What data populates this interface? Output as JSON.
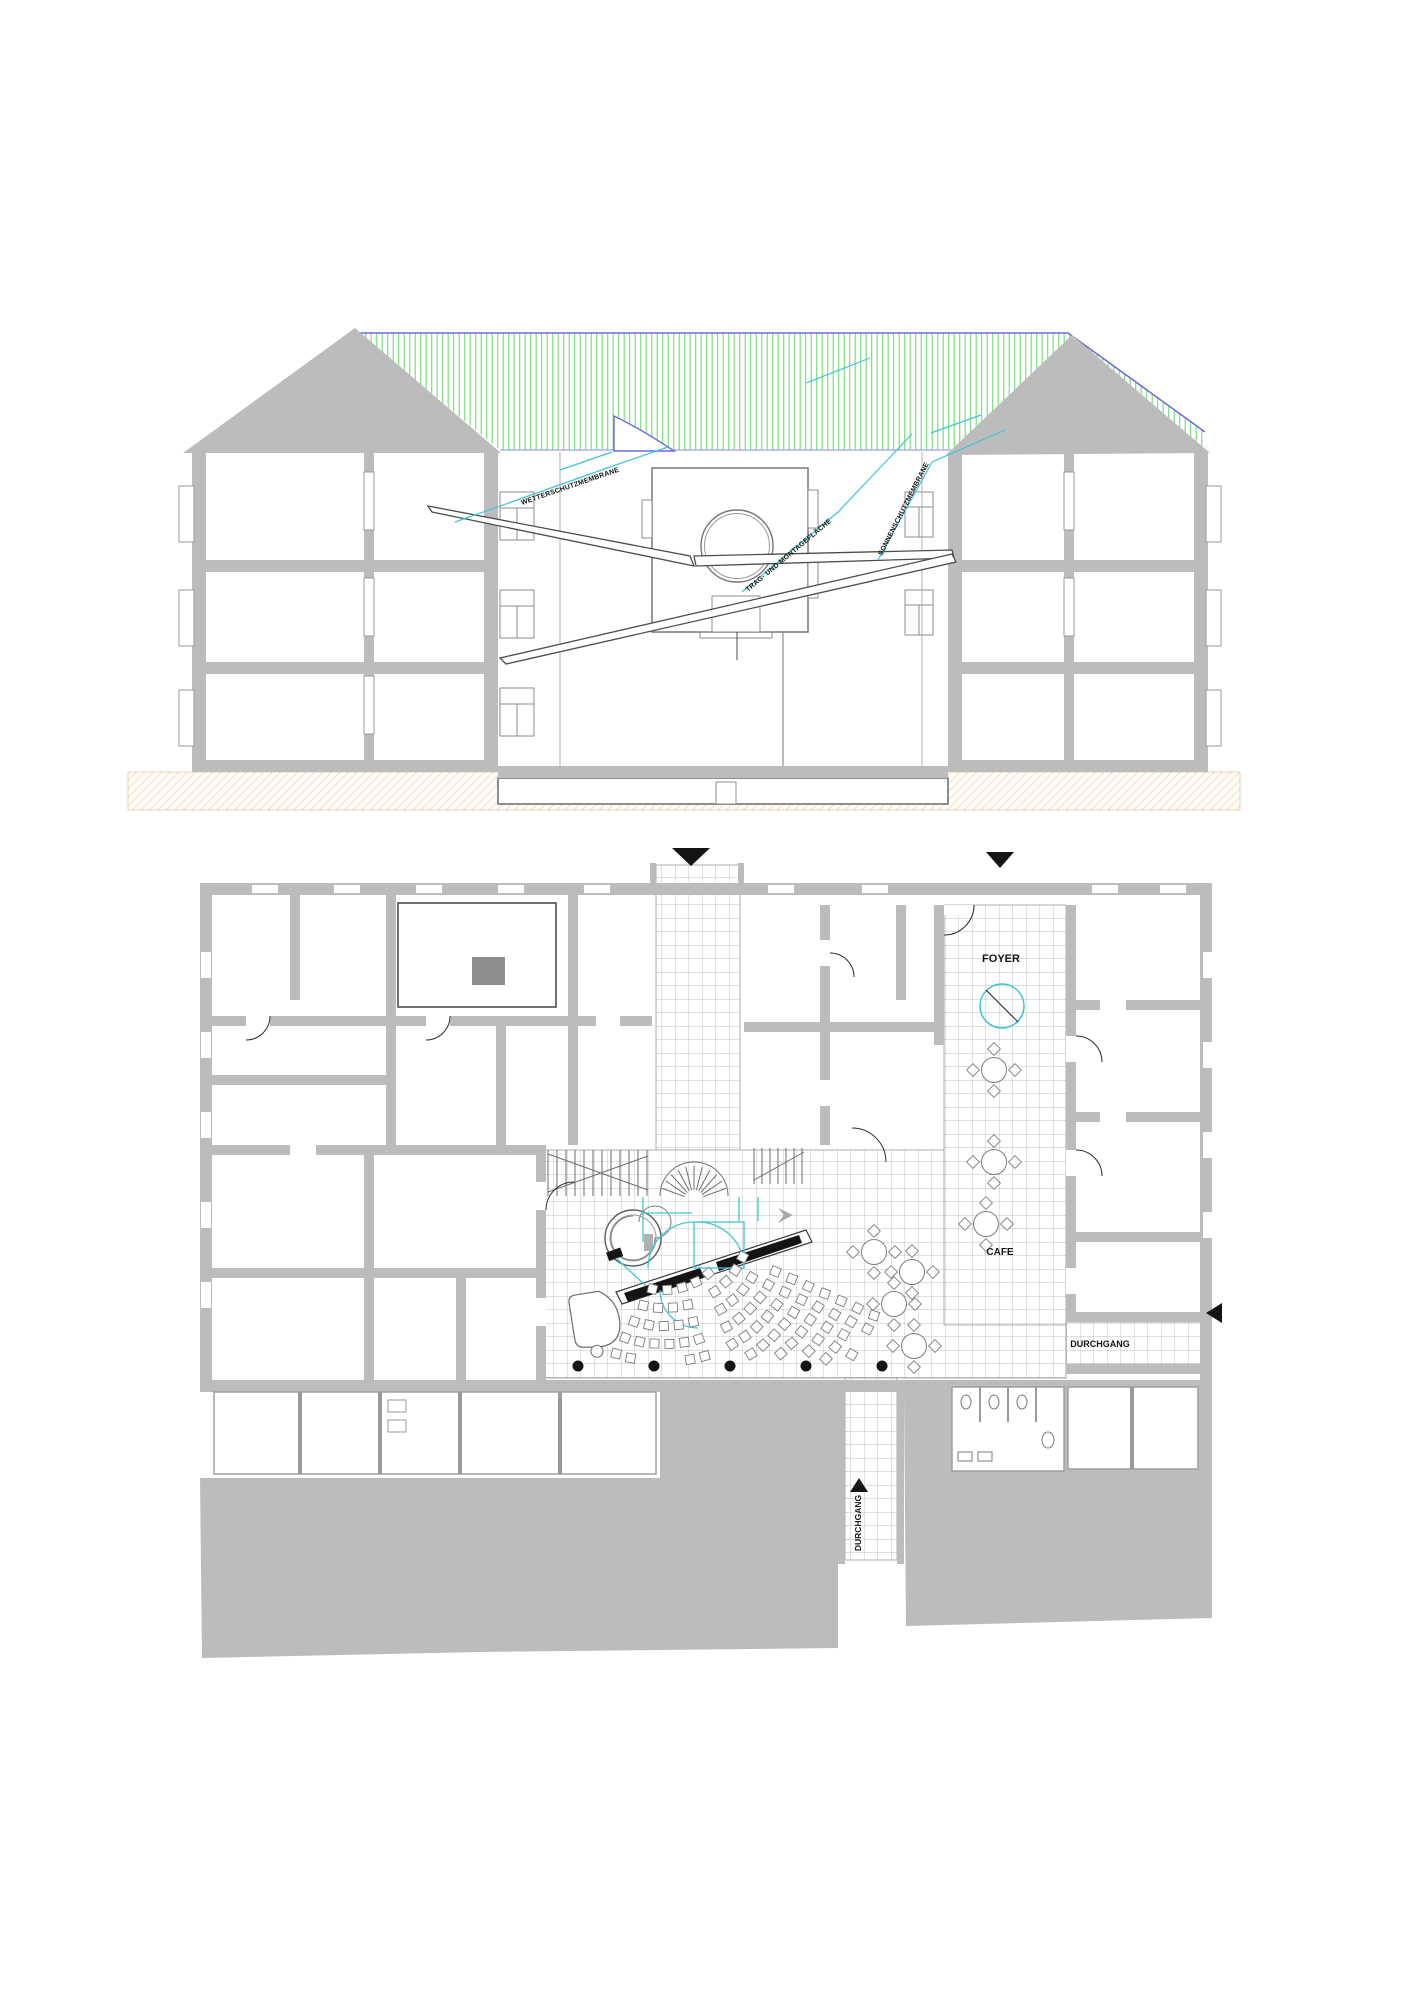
{
  "drawing": {
    "kind": "architectural sheet with building cross-section above and ground-floor plan below"
  },
  "section": {
    "annotations": {
      "roof_membrane": "WETTERSCHUTZMEMBRANE",
      "canopy": "TRAG- UND MONTAGEFLÄCHE",
      "sunshade": "SONNENSCHUTZMEMBRANE"
    }
  },
  "plan": {
    "labels": {
      "foyer": "FOYER",
      "cafe": "CAFE",
      "passage_east": "DURCHGANG",
      "passage_south": "DURCHGANG"
    }
  },
  "colors": {
    "wall": "#bcbcbc",
    "roof_membrane_green": "#70dd70",
    "roof_edge_blue": "#6b6be0",
    "leader_cyan": "#3cc7d6",
    "ground_hatch_orange": "#f3cda6",
    "ink": "#141414"
  }
}
